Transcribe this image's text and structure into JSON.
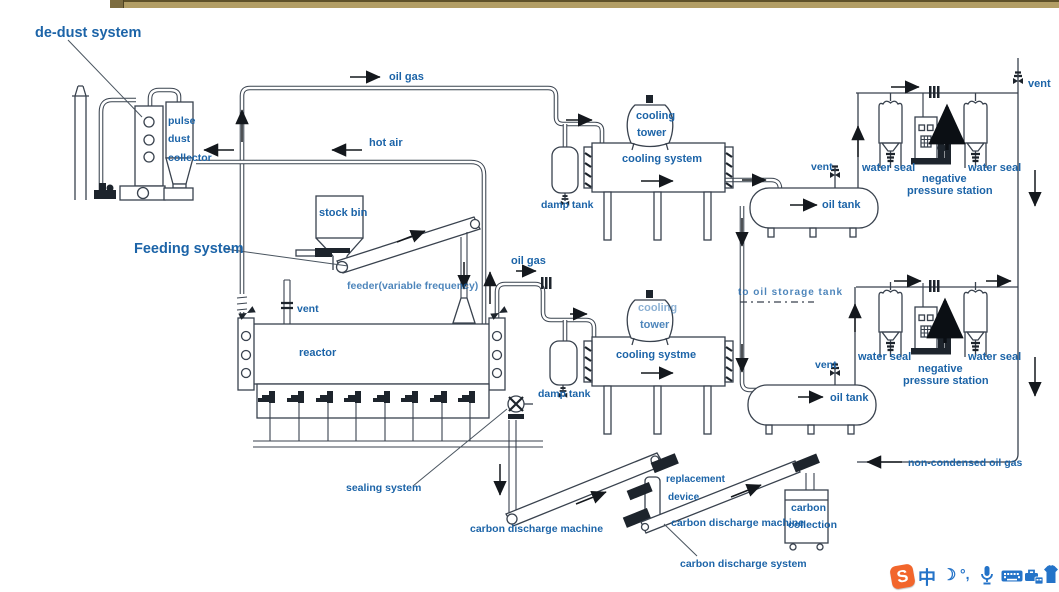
{
  "colors": {
    "label_blue": "#1c64a8",
    "line": "#39424e",
    "top_bar": "#b29e65",
    "sogou_orange": "#f2662c",
    "tray_blue": "#2473c8"
  },
  "labels": {
    "de_dust_system": "de-dust system",
    "pulse": "pulse",
    "dust": "dust",
    "collector": "collector",
    "oil_gas_top": "oil gas",
    "hot_air": "hot air",
    "feeding_system": "Feeding system",
    "stock_bin": "stock bin",
    "feeder": "feeder(variable frequency)",
    "vent_reactor": "vent",
    "reactor": "reactor",
    "sealing_system": "sealing system",
    "oil_gas_mid": "oil gas",
    "damp_tank_1": "damp tank",
    "damp_tank_2": "damp tank",
    "cooling_1": "cooling",
    "tower_1": "tower",
    "cooling_system_1": "cooling system",
    "cooling_2": "cooling",
    "tower_2": "tower",
    "cooling_system_2": "cooling systme",
    "vent_tank_1": "vent",
    "oil_tank_1": "oil tank",
    "water_seal_1a": "water seal",
    "water_seal_1b": "water seal",
    "negative_1": "negative",
    "pressure_station_1": "pressure station",
    "vent_right": "vent",
    "to_oil_storage_tank": "to oil storage tank",
    "vent_tank_2": "vent",
    "oil_tank_2": "oil tank",
    "water_seal_2a": "water seal",
    "water_seal_2b": "water seal",
    "negative_2": "negative",
    "pressure_station_2": "pressure station",
    "non_condensed": "non-condensed oil gas",
    "carbon_discharge_machine_1": "carbon discharge machine",
    "replacement": "replacement",
    "device": "device",
    "carbon_discharge_machine_2": "carbon discharge machine",
    "carbon": "carbon",
    "collection": "collection",
    "carbon_discharge_system": "carbon discharge system"
  },
  "tray": {
    "sogou_letter": "S",
    "chinese_mode": "中",
    "moon_icon": "☽",
    "punctuation": "°,"
  }
}
